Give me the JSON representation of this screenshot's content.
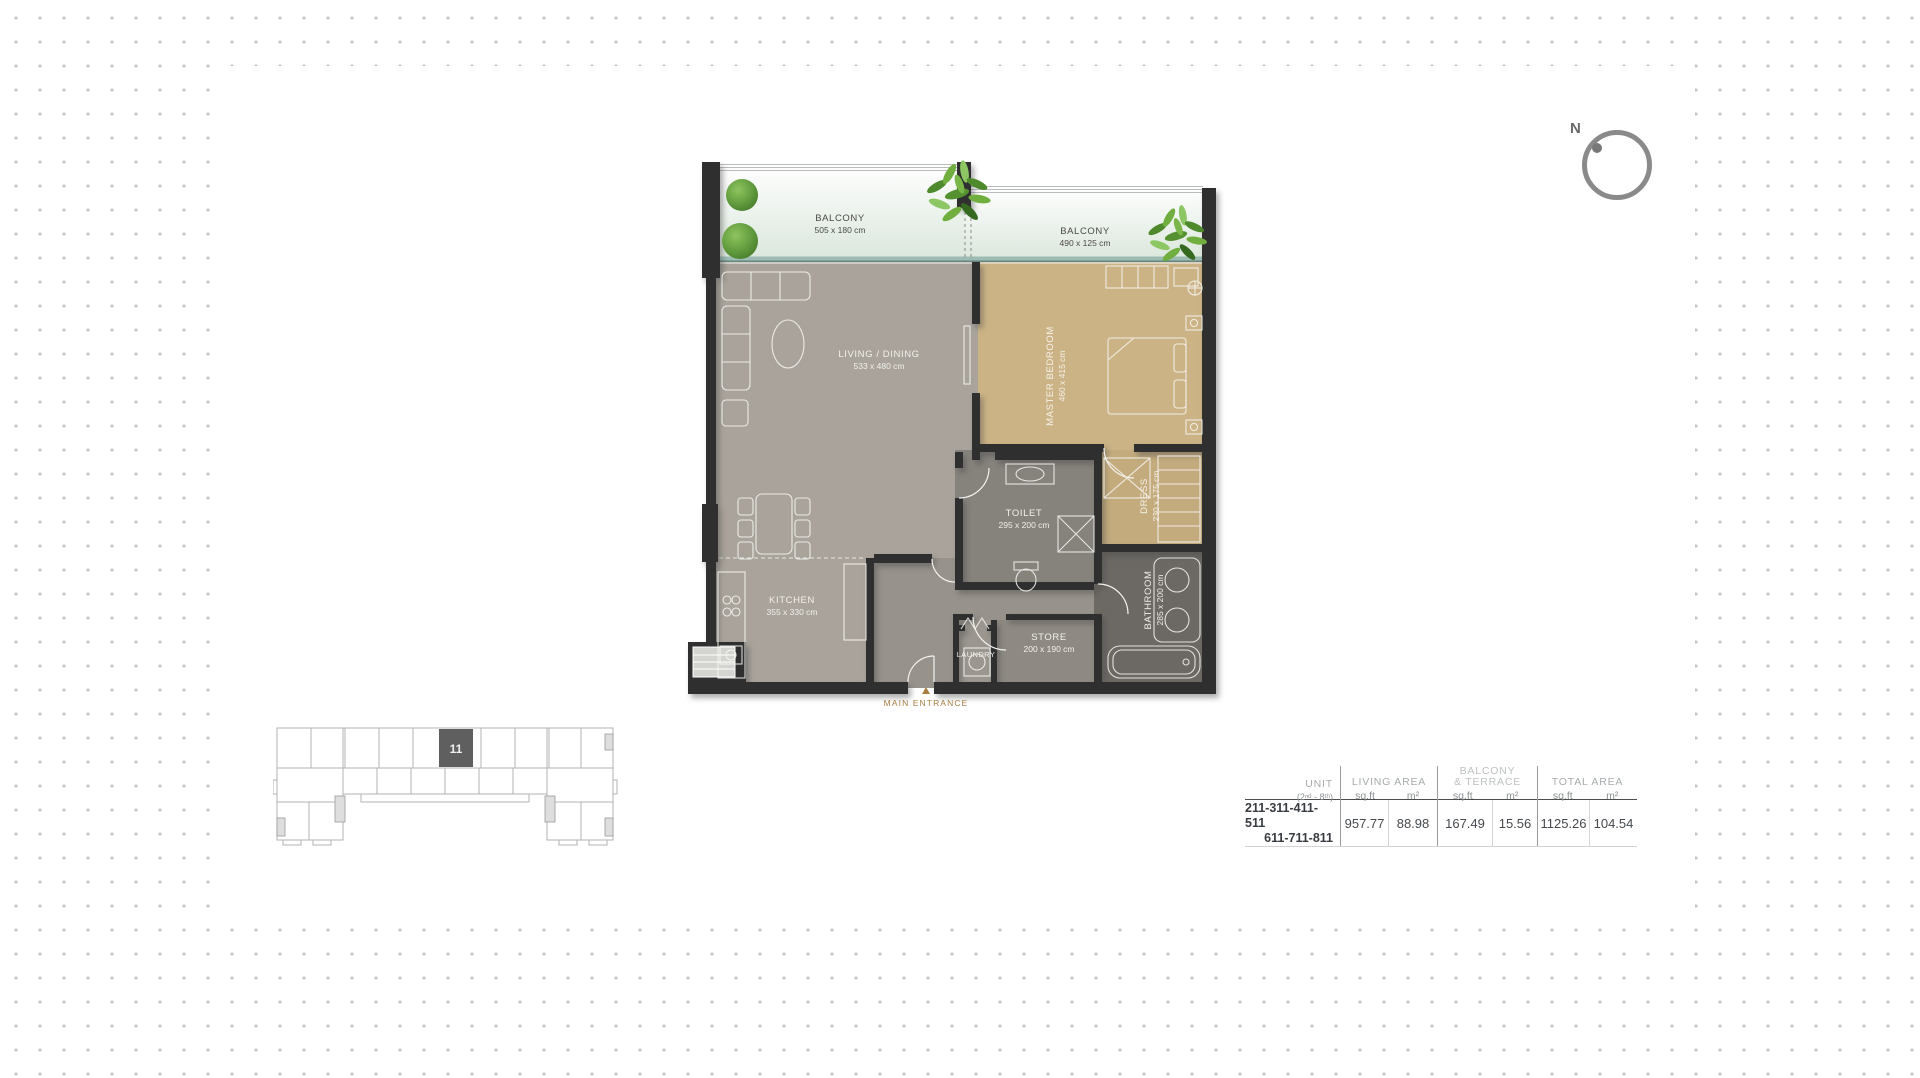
{
  "compass": {
    "label": "N"
  },
  "floor_plan": {
    "balcony1": {
      "name": "BALCONY",
      "dims": "505 x 180 cm"
    },
    "balcony2": {
      "name": "BALCONY",
      "dims": "490 x 125 cm"
    },
    "living": {
      "name": "LIVING / DINING",
      "dims": "533 x 480 cm"
    },
    "master": {
      "name": "MASTER BEDROOM",
      "dims": "460 x 415 cm"
    },
    "kitchen": {
      "name": "KITCHEN",
      "dims": "355 x 330 cm"
    },
    "toilet": {
      "name": "TOILET",
      "dims": "295 x 200 cm"
    },
    "dress": {
      "name": "DRESS",
      "dims": "230 x 175 cm"
    },
    "bathroom": {
      "name": "BATHROOM",
      "dims": "285 x 200 cm"
    },
    "store": {
      "name": "STORE",
      "dims": "200 x 190 cm"
    },
    "laundry": {
      "name": "LAUNDRY"
    },
    "entrance": {
      "label": "MAIN ENTRANCE"
    }
  },
  "key_plan": {
    "unit_number": "11"
  },
  "area_table": {
    "unit_header": "UNIT",
    "unit_subheader": "(2ⁿᵈ - 8ᵗʰ)",
    "col_living": "LIVING AREA",
    "col_balcony_line1": "BALCONY",
    "col_balcony_line2": "& TERRACE",
    "col_total": "TOTAL AREA",
    "sqft_label": "sq.ft",
    "sqm_label": "m²",
    "row": {
      "units_line1": "211-311-411-511",
      "units_line2": "611-711-811",
      "living_sqft": "957.77",
      "living_sqm": "88.98",
      "balcony_sqft": "167.49",
      "balcony_sqm": "15.56",
      "total_sqft": "1125.26",
      "total_sqm": "104.54"
    }
  },
  "colors": {
    "wall": "#2f2f2f",
    "living_floor": "#a9a39b",
    "bedroom_floor": "#cbb385",
    "bathroom_floor": "#6c6863",
    "accent_entrance": "#a87d42"
  }
}
